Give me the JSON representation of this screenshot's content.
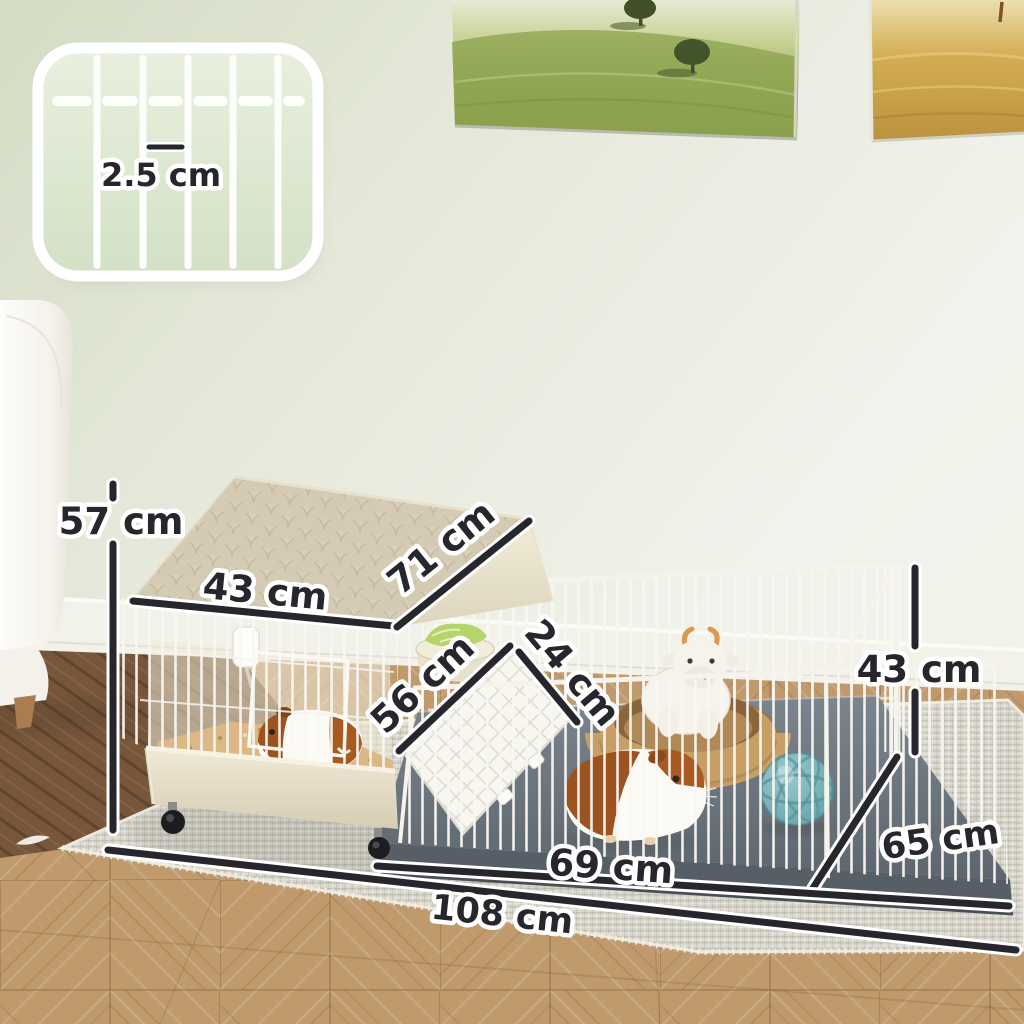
{
  "labels": {
    "house_height": "57 cm",
    "roof_width": "43 cm",
    "roof_slope": "71 cm",
    "ramp_length": "56 cm",
    "ramp_width": "24 cm",
    "playpen_height": "43 cm",
    "depth": "65 cm",
    "playpen_width": "69 cm",
    "overall_width": "108 cm",
    "wire_spacing": "2.5 cm"
  },
  "colors": {
    "wall": "#e4e7db",
    "baseboard": "#f4f3ec",
    "floor_wood": "#c09b6e",
    "dark_floor": "#775639",
    "rug": "#d8d5ca",
    "cage_wire": "#f8f6f1",
    "house_plastic": "#e9e2cd",
    "roof": "#d9d0ba",
    "playpen_tray": "#646e77",
    "dimension_line": "#26262c",
    "label_text": "#26262c",
    "label_halo": "#ffffff",
    "ball": "#7cb4ba",
    "basket": "#c69e66",
    "guinea_pig_brown": "#9d5320",
    "lettuce": "#b5d46c"
  }
}
